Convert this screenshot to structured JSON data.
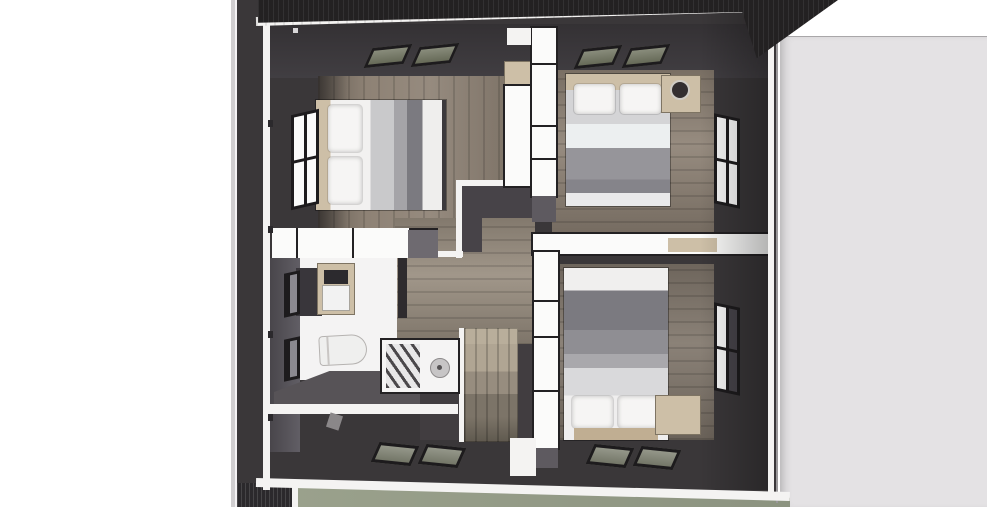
{
  "scene": {
    "description": "3D top-down dollhouse render of an upper floor plan with three bedrooms, bathroom, staircase and built-in closets; adjacent light-gray roof plane on the right and sage ground visible along the bottom edge",
    "rooms": [
      "bedroom-top-left",
      "bedroom-top-right",
      "bedroom-bottom-right",
      "bathroom",
      "hallway-stairwell"
    ],
    "objects": [
      "double-bed x3",
      "pillows",
      "nightstand-with-round-mirror",
      "wardrobe-units",
      "toilet",
      "vanity-sink-with-mirror",
      "shower-enclosure",
      "staircase",
      "windows x4",
      "roof-skylights x8"
    ]
  },
  "colors": {
    "wall_dark": "#3a3739",
    "wall_darker": "#2b292c",
    "eave_dark": "#232122",
    "white_cut": "#f4f3f2",
    "white_bright": "#fbfbfa",
    "wood_floor": "#8e8275",
    "wood_floor_dark": "#81776c",
    "hall_wood": "#998e80",
    "stair_light": "#b9ae9b",
    "stair_dark": "#5f594f",
    "tan_wood": "#cdbfa7",
    "tan_deep": "#c0ae92",
    "bed_white": "#f2f1f0",
    "bed_gray_light": "#c9c9cb",
    "bed_gray_mid": "#96959a",
    "bed_gray_dark": "#7b7a80",
    "bath_floor_white": "#f4f3f3",
    "bath_gray_floor": "#575357",
    "window_frame": "#1d1b1d",
    "pane_white": "#fafafa",
    "skylight_glass": "#6f735f",
    "skylight_glass_light": "#7d8070",
    "sage_ground": "#9aa18c",
    "sage_ground_dark": "#8c9380",
    "neighbor_roof": "#e4e2e4",
    "neighbor_strip": "#d0ced0",
    "stairwell_dark": "#474348",
    "stairwell_void": "#413d40",
    "gray_cabinet": "#6e6a70",
    "gray_cap": "#5e5a60"
  }
}
